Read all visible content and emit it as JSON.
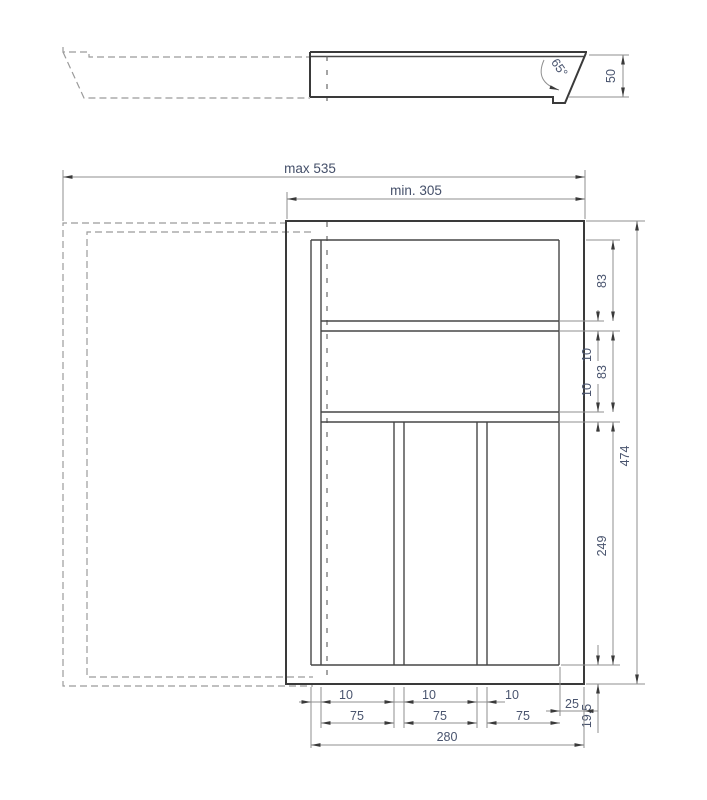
{
  "section_view": {
    "angle_label": "65°",
    "height_label": "50"
  },
  "plan_view": {
    "max_width_label": "max 535",
    "min_width_label": "min. 305",
    "top_compartment_depth": "83",
    "top_divider_thickness": "10",
    "middle_compartment_depth": "83",
    "middle_divider_thickness": "10",
    "bottom_compartment_depth": "249",
    "overall_depth": "474",
    "slot_dividers": [
      "10",
      "10",
      "10"
    ],
    "slot_widths": [
      "75",
      "75",
      "75"
    ],
    "right_wall_width": "25",
    "bottom_wall_depth": "19,5",
    "inner_width": "280"
  }
}
